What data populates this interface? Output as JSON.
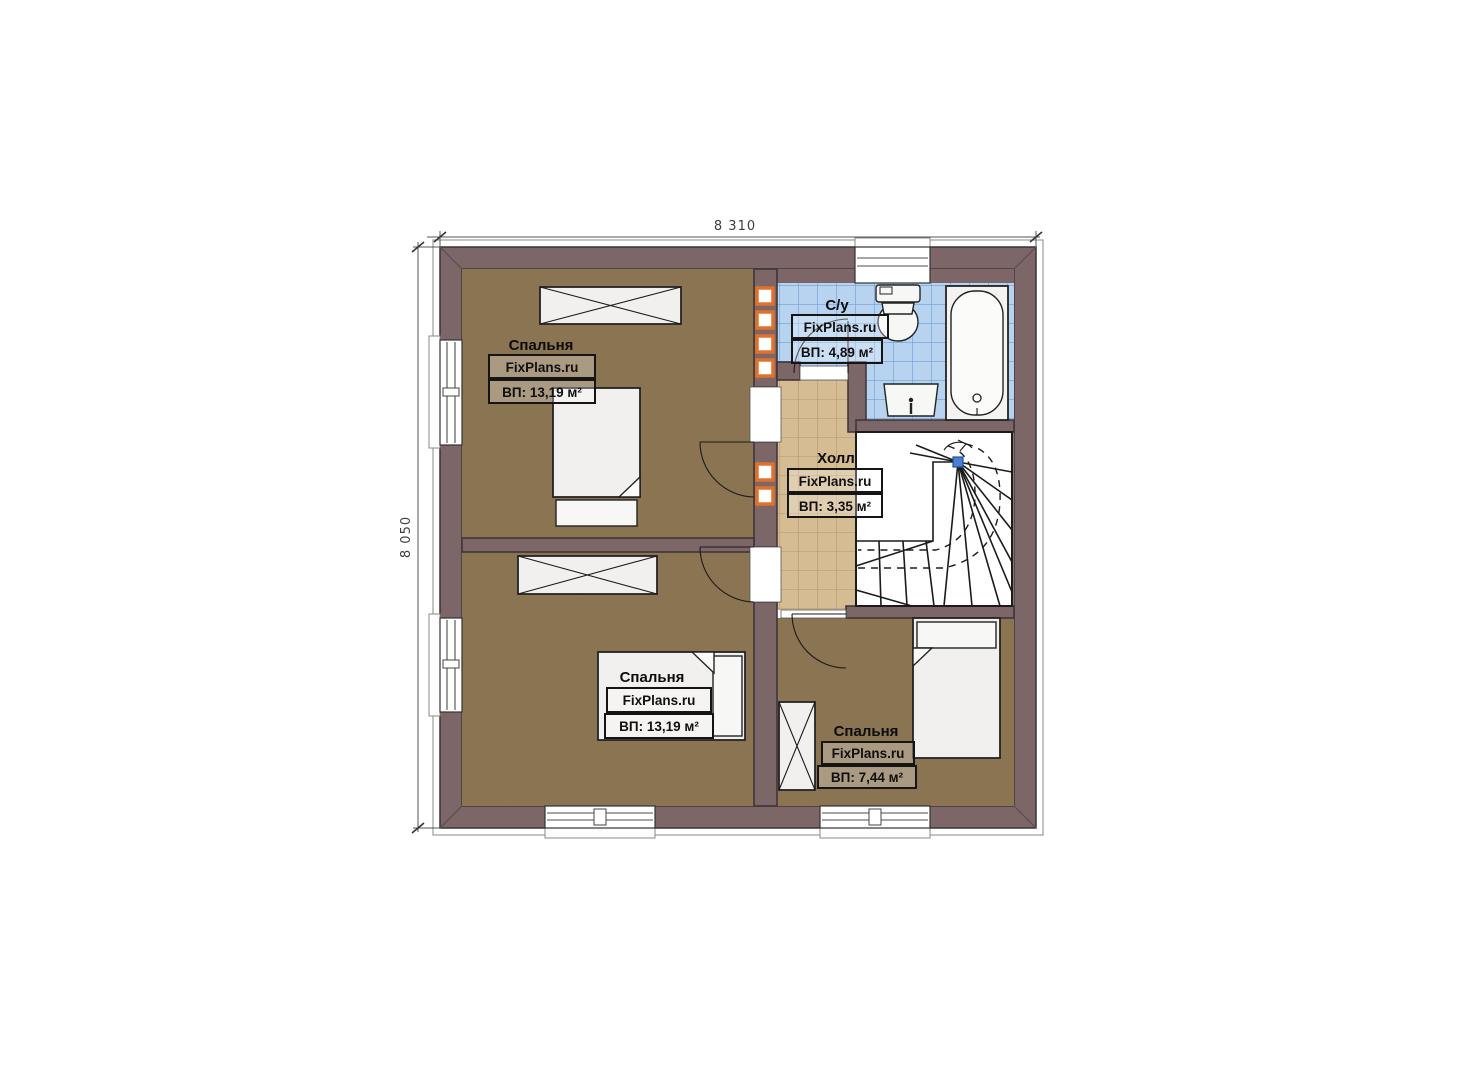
{
  "plan": {
    "type": "floor-plan",
    "floor_note": "second floor of a house, FixPlans.ru drawing"
  },
  "dimensions": {
    "width_label": "8 310",
    "height_label": "8 050"
  },
  "rooms": [
    {
      "id": "bedroom-top-left",
      "name": "Спальня",
      "brand": "FixPlans.ru",
      "area": "ВП: 13,19 м²"
    },
    {
      "id": "bathroom",
      "name": "С/у",
      "brand": "FixPlans.ru",
      "area": "ВП: 4,89 м²"
    },
    {
      "id": "hall",
      "name": "Холл",
      "brand": "FixPlans.ru",
      "area": "ВП: 3,35 м²"
    },
    {
      "id": "bedroom-bottom-left",
      "name": "Спальня",
      "brand": "FixPlans.ru",
      "area": "ВП: 13,19 м²"
    },
    {
      "id": "bedroom-bottom-right",
      "name": "Спальня",
      "brand": "FixPlans.ru",
      "area": "ВП: 7,44 м²"
    }
  ],
  "colors": {
    "wall": "#7c6668",
    "bedroom_floor": "#8c7454",
    "hall_tile": "#d5bc92",
    "hall_grid": "#b09772",
    "bath_tile": "#b7d3f0",
    "bath_grid": "#6d9ed6",
    "duct_orange": "#e0722c",
    "stair_dot_blue": "#4a7fd4",
    "background": "#ffffff"
  }
}
